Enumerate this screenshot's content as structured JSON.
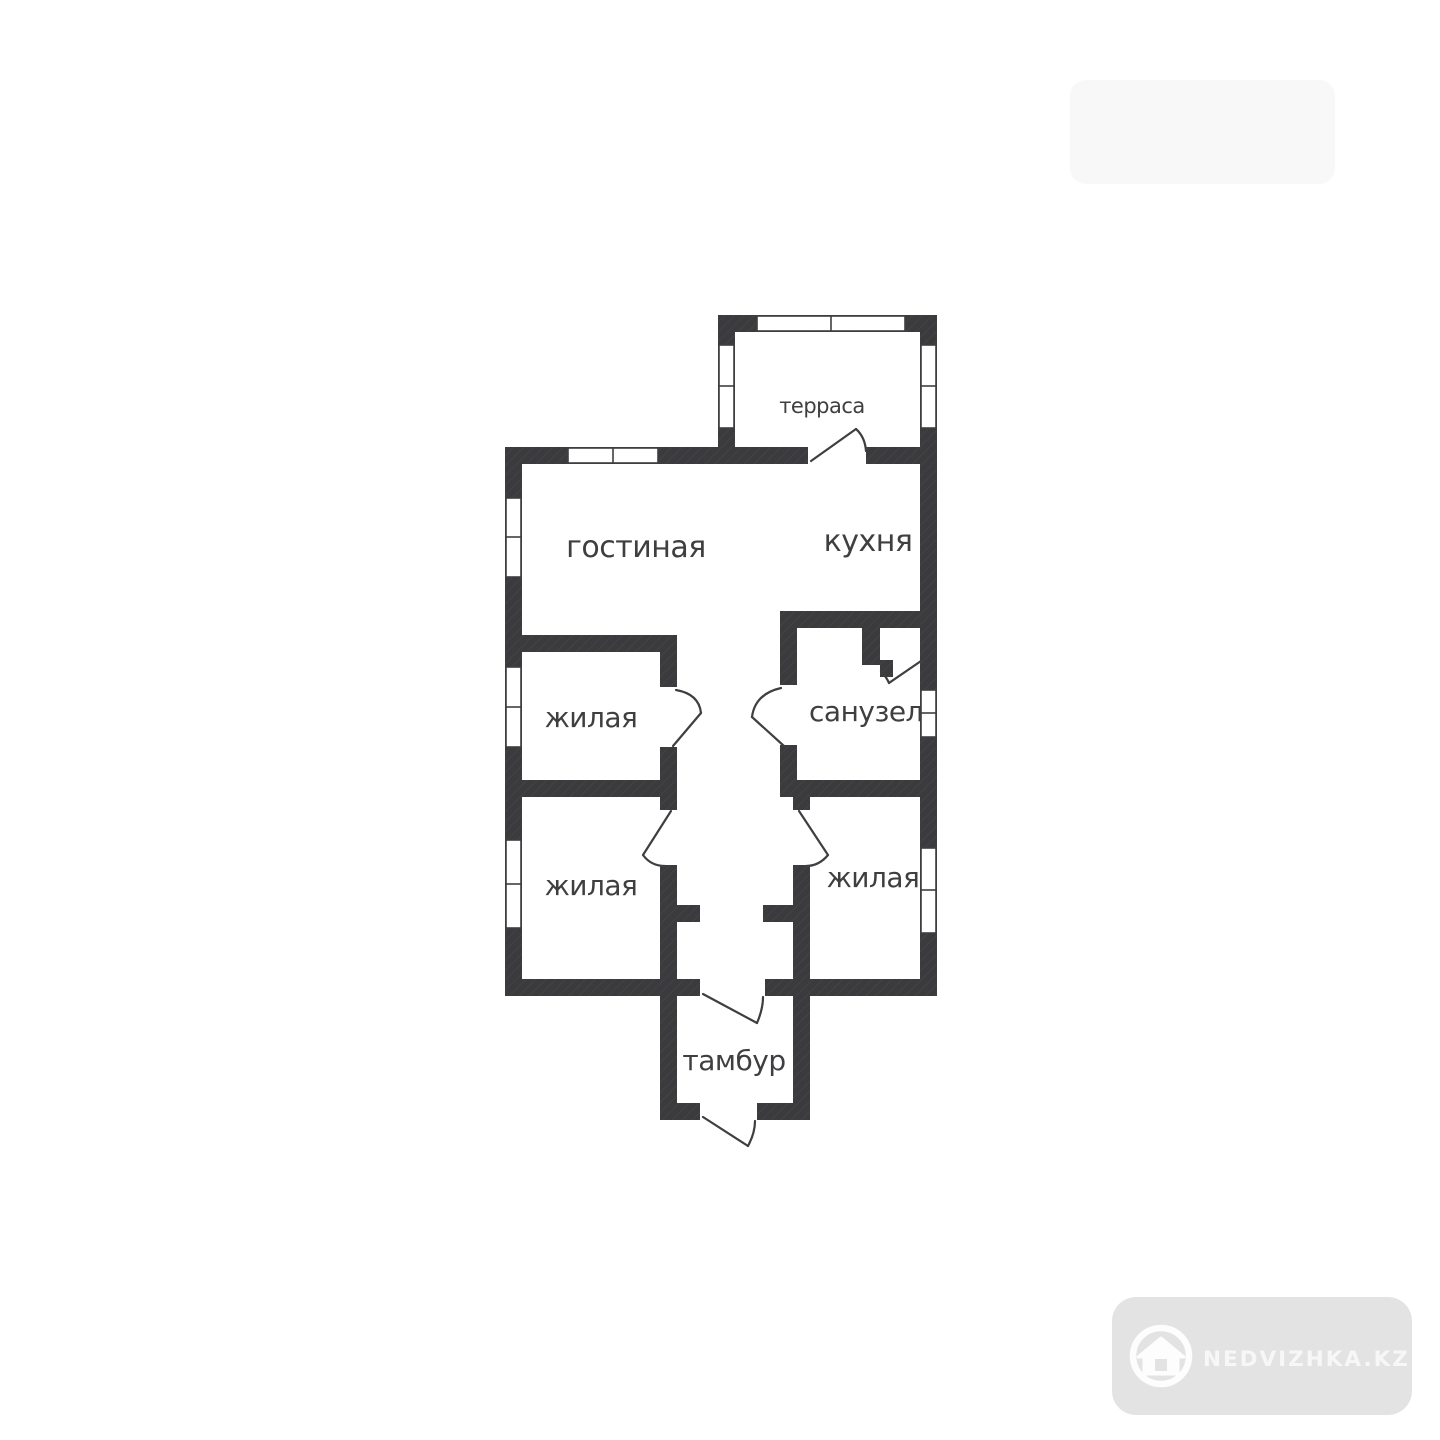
{
  "plan": {
    "wall_color": "#3b3b3e",
    "line_color": "#3f3f41",
    "background_color": "#ffffff",
    "rooms": [
      {
        "id": "terrace",
        "label": "терраса"
      },
      {
        "id": "living",
        "label": "гостиная"
      },
      {
        "id": "kitchen",
        "label": "кухня"
      },
      {
        "id": "bedroom1",
        "label": "жилая"
      },
      {
        "id": "bathroom",
        "label": "санузел"
      },
      {
        "id": "bedroom2",
        "label": "жилая"
      },
      {
        "id": "bedroom3",
        "label": "жилая"
      },
      {
        "id": "vestibule",
        "label": "тамбур"
      }
    ]
  },
  "watermark": {
    "badge_text": "NEDVIZHKA.KZ",
    "badge_color": "#e3e3e3",
    "badge_text_color": "#f7f7f7",
    "icon": "house-in-circle-icon"
  }
}
